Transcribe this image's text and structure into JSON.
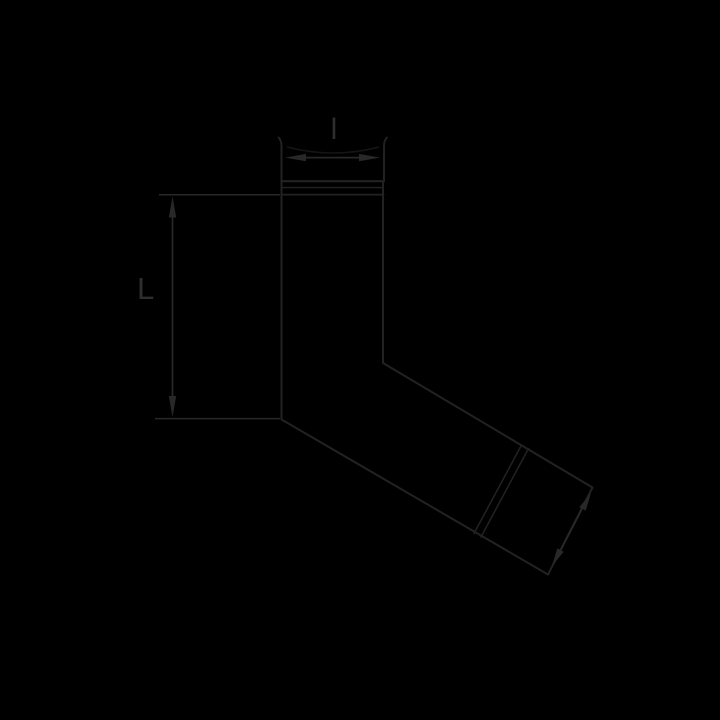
{
  "diagram": {
    "subject": "pipe-elbow-technical-drawing",
    "labels": {
      "top_dimension": "l",
      "left_dimension": "L"
    },
    "colors": {
      "background": "#000000",
      "outline": "#222222",
      "collar_light": "#1b1b1b",
      "faint": "#151515",
      "dimension": "#282828",
      "label": "#2e2e2e"
    }
  }
}
